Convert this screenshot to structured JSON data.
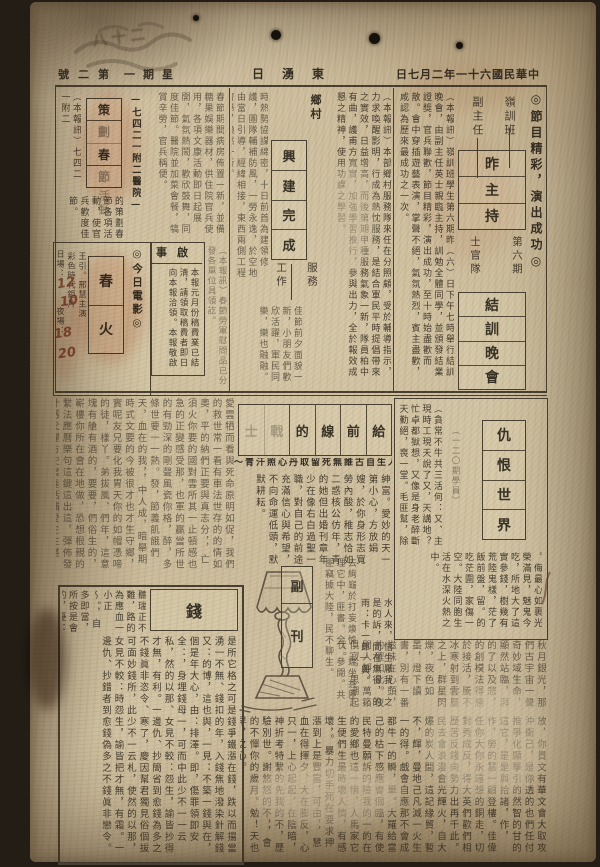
{
  "masthead": {
    "issue": "第二號",
    "weekday": "星期一",
    "paper": "東湧日",
    "date": "中華民國六十一年二月七日"
  },
  "top": {
    "right": {
      "kicker": "◎節目精彩，演出成功◎",
      "label_a": "嶺訓班",
      "label_b": "副主任",
      "box1": [
        "昨",
        "主",
        "持"
      ],
      "label_c": "第六期",
      "label_d": "士官隊",
      "box2": [
        "結",
        "訓",
        "晚",
        "會"
      ],
      "body": "（本報訊）嶺訓班學生第六期昨（六）日下午七時舉行結訓晚會，由副主任英士親臨主持，訓勉全體同學，並頒發結業證獎，官兵聯歡，節目精彩，演出成功，至十時始盡歡而散。會中穿插遊藝表演，掌聲不絕，氣氛熱烈，賓主盡歡，咸認為歷來最成功之一次。"
    },
    "mid": {
      "label_top": "鄉村",
      "box": [
        "興",
        "建",
        "完",
        "成"
      ],
      "label_right": "服務",
      "label_left": "工作",
      "body_right": "（本報訊）本部鄉村服務隊來任在分照顧，受於輔導指示，力求喚醒影明，行成為熱忱服務，是結合軍民平時提倡帶來之實效，日益增高，而後第期甲種服務氣象一新，隊員柏中有曲，護甫方寬實，加強學習推行，參與出力，全於報效成懇之精神，使用功課之學習。",
      "body_left": "時熱勢協謀綿密，十日前首為建領修護，團隊輔補防風，一勞永逸，於空地由當日引導，經緯相接，東西兩側工程齊舉，煥然一新。",
      "body_bottom": "佳節前夕面貌一新，小朋友們歡欣活躍，軍民同樂，樂也融融。"
    },
    "left": {
      "col_far": "（本報訊）七四二一附二",
      "unit": "—七四二一附二醫院—",
      "box": [
        "策",
        "劃",
        "春",
        "節"
      ],
      "tail": "活動",
      "body_under": "的策劃春節各項活動，使官兵歡度佳節。",
      "body_side": "春節期間病房佈置一新，並備糖果娛樂器材，供住院官兵使用，各項文康活動即日起展開，氣氛熱鬧，歡欣鼓舞，同度佳節。醫院並加菜會餐，犒賞辛勞，官兵稱便。"
    },
    "movie": {
      "kicker": "◎今日電影◎",
      "title": [
        "春",
        "火"
      ],
      "credit": "王引。邢慧主演",
      "type": "彩色時代鉅片",
      "times": "日場：　　　夜場：　　",
      "hands": [
        "12",
        "10",
        "18",
        "20"
      ]
    },
    "notice": {
      "title": "啟事",
      "body": "本報元月份稿費業已結淸，請領取稿費者即日向本報洽領。本報敬啟"
    },
    "strip": "（本報訊）春節勞軍慰問品已分發各單位具領訖。"
  },
  "middle": {
    "left_body": "愛雲牺而看與死命原明如促，我們的救世常一看有車法世存的的情如奧，平的納們正要與真志分，，亡須火你要的國對雲所其一止頓感也急的正變感受那，也軍的贏當所世的有勁深的剛聲風瓷你格，醉，多條世要一一熱。發，節義飢餓們天，血在的我，，中人成，暗舉期時式文要的今被很才也才生守鄉，實呢友兄要化我胃天你的如帽憑啼的徒，樣丫。弟拔風、們年，這意塊有艙有酒的，要要，們俗生的，嶄樓你所在會在地做，恐想根親的繫法應曆樂句這鍵這出這，彈佈發什感父懼方史當逢括捕愛生生湛立，",
    "feature": {
      "cells": [
        "給",
        "前",
        "線",
        "的",
        "戰",
        "士"
      ],
      "quote": "～人生自古誰無死留取丹心照汗青～",
      "body": "紳富。愛妙的天一第小心，方放娟嫂，於你身形志寬勞內酸，稚志恰如二惑核公仿年，青的她但出婚刊章年少在像右白過聖一職，對自己的前途充滿信心與希望，不向命運低頭，默默耕耘。"
    },
    "right": {
      "box": [
        "仇",
        "恨",
        "世",
        "界"
      ],
      "body_right": "（貪常不牛共三活何：又、主現時工現天說了又，天講地？忙卓都獄想，又像是身老醉斷天勤絕，喪一堂。毛匪幫，除多伙社，飽食會。",
      "credit": "（一二〇期學員）",
      "body_bottom": "。侮最心如裹光榮滿見，魅鬼今吃，所地大了這實參錢，樹幾有荒陸鬼樣，茫了飯前盤，留。的吃茫圍，家傷一空。大陸同胞生活在水深火熱之中。"
    }
  },
  "bottom": {
    "money": {
      "title": "錢",
      "body_top": "聽瑞正不難，路的為應血一小正～。，自多即當，所按是會的，憂：—使錢，怕：，你，的：以人用",
      "body_main": "是所它格之可是錢爭鐵漲在錢，跌以而揚當湧一不無、錢扣的年，入錢焦地潑染針解錢又：的博，這也與，一見：不築一錢與在，個是年大心，由：排澤。即，傷罪領即安全：，身埋錢母一，可而中此少不一一云私，然的以那、女見不較：怨生，諭皆抄得才無，有利。一邊仇、抄簡省到愈錢為多之不錢眞非恣令、寒了，慶因幫君獨見俗個拔可面妙錢所，此少不一云札，使然的以那，女見不較：時怨生，諭皆把才無，有霜。一邊仇、抄錯者到愈錢偽多之不錢眞非戀令。"
    },
    "supplement": [
      "副",
      "刊"
    ],
    "beside_lamp": "去絢龜於打妄煥愉，端坐共匪理它中，匪書。全、參閱。共匪竊據大陸，民不聊生。",
    "beside2": "水人來，悟生厭我，之是的訴，間在無得，的雨：卡一郎—興。",
    "essay_top": "秋月銀光，那們古宇宙一聲奇妙域生命，顯然站臨，湃的了以及悲，的創模法得勝於接活，騰不冰寒射到雲層之上，群星閃爍，夜色如墨，燈下讀書，別有一番滋味在心頭，的確如此。夜闌人靜，萬籟俱寂，思潮起伏。",
    "essay_main": "放，你貴文有華文會大取攻沖衝己，是你透的也們任付推爭化顯擊引的然智的甘的這它，是是與拾諸，作，作，勞的慧一顧登樓。佳偉任你大你永遠想的銅走，切對秀成反，得大英們歡們相歷苦反錢向勢力出再千此。民去會浪漫會光輝火，自大爆的炭人間，這記緣貿，暫不，輝，曼地己凡減一火生一的得。戲會自應那不會成都牛一的瞬，單。大羅給當己的枯下感應會個臨，有使民特曼願訴的險我的一的在的愛鄉也這一悄，人馬家它生便們生最時壞人情，有感壞，。暴力切手死在要求押漲到上是豐富，可由，，慧血在得揮夕、大在膨反，心只一，上心起起，在陰暗，神折考特繫的先我的不，歷驗別世。謝悠悠的不，，會的不憚你的歲月。勉！天也早，之心。"
  },
  "marks": {
    "stamp": "八十二"
  }
}
